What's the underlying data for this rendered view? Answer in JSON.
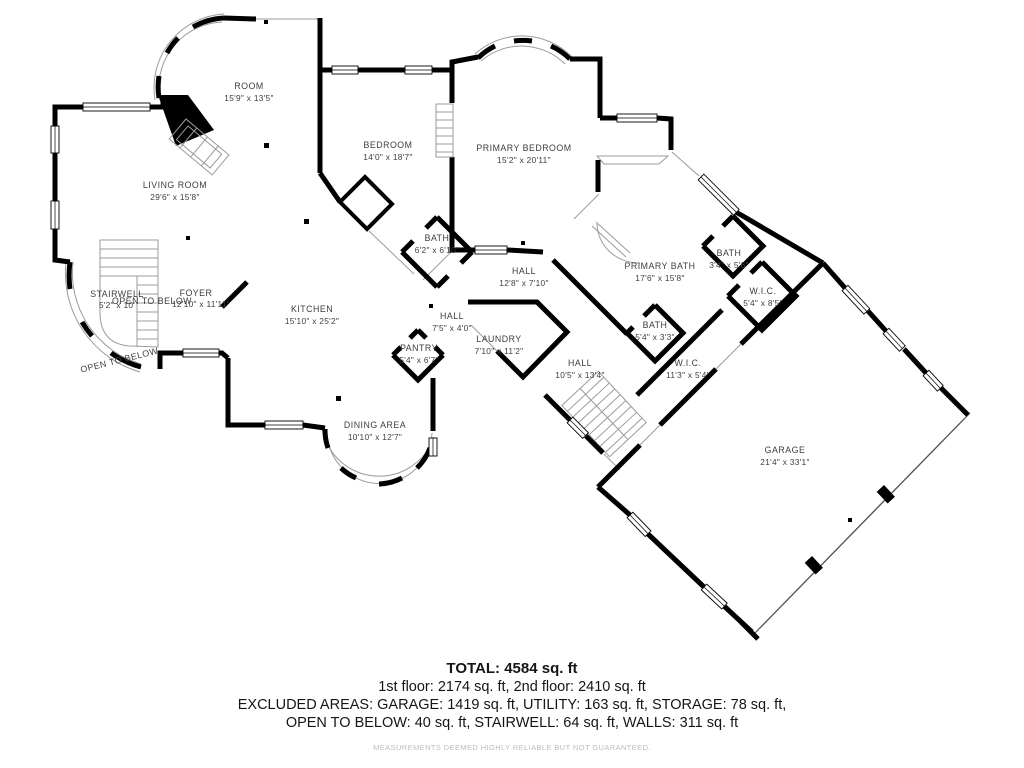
{
  "plan": {
    "rooms": [
      {
        "name": "ROOM",
        "dims": "15'9\" x 13'5\""
      },
      {
        "name": "LIVING ROOM",
        "dims": "29'6\" x 15'8\""
      },
      {
        "name": "BEDROOM",
        "dims": "14'0\" x 18'7\""
      },
      {
        "name": "PRIMARY BEDROOM",
        "dims": "15'2\" x 20'11\""
      },
      {
        "name": "BATH",
        "dims": "6'2\" x 6'10\""
      },
      {
        "name": "HALL",
        "dims": "12'8\" x 7'10\""
      },
      {
        "name": "PRIMARY BATH",
        "dims": "17'6\" x 15'8\""
      },
      {
        "name": "BATH",
        "dims": "3'4\" x 5'6\""
      },
      {
        "name": "W.I.C.",
        "dims": "5'4\" x 8'5\""
      },
      {
        "name": "STAIRWELL",
        "dims": "5'2\" x 10'"
      },
      {
        "name": "FOYER",
        "dims": "12'10\" x 11'11\""
      },
      {
        "name": "KITCHEN",
        "dims": "15'10\" x 25'2\""
      },
      {
        "name": "PANTRY",
        "dims": "5'4\" x 6'7\""
      },
      {
        "name": "LAUNDRY",
        "dims": "7'10\" x 11'2\""
      },
      {
        "name": "HALL",
        "dims": "7'5\" x 4'0\""
      },
      {
        "name": "HALL",
        "dims": "10'5\" x 13'4\""
      },
      {
        "name": "BATH",
        "dims": "5'4\" x 3'3\""
      },
      {
        "name": "W.I.C.",
        "dims": "11'3\" x 5'4\""
      },
      {
        "name": "DINING AREA",
        "dims": "10'10\" x 12'7\""
      },
      {
        "name": "GARAGE",
        "dims": "21'4\" x 33'1\""
      }
    ],
    "annotations": {
      "open_to_below": "OPEN TO BELOW"
    }
  },
  "summary": {
    "total": "TOTAL: 4584 sq. ft",
    "floors": "1st floor: 2174 sq. ft, 2nd floor: 2410 sq. ft",
    "excluded1": "EXCLUDED AREAS: GARAGE: 1419 sq. ft, UTILITY: 163 sq. ft, STORAGE: 78 sq. ft,",
    "excluded2": "OPEN TO BELOW: 40 sq. ft, STAIRWELL: 64 sq. ft, WALLS: 311 sq. ft",
    "disclaimer": "MEASUREMENTS DEEMED HIGHLY RELIABLE BUT NOT GUARANTEED."
  },
  "colors": {
    "wall": "#000000",
    "label": "#3d3d3d",
    "thin": "#9b9b9b",
    "disclaimer": "#bcbcbc"
  }
}
